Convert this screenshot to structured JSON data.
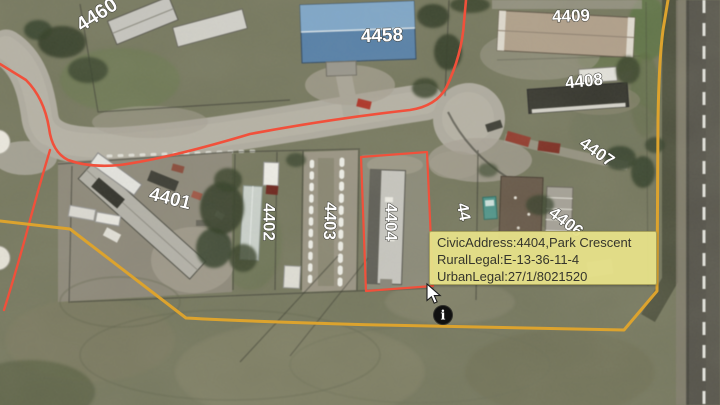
{
  "map_labels": {
    "l4460": "4460",
    "l4458": "4458",
    "l4409": "4409",
    "l4408": "4408",
    "l4407": "4407",
    "l4406": "4406",
    "l4405_partial": "44",
    "l4404": "4404",
    "l4403": "4403",
    "l4402": "4402",
    "l4401": "4401"
  },
  "tooltip": {
    "civic_address": "CivicAddress:4404,Park Crescent",
    "rural_legal": "RuralLegal:E-13-36-11-4",
    "urban_legal": "UrbanLegal:27/1/8021520",
    "background": "#e5e088",
    "text_color": "#35352c"
  },
  "info_marker": {
    "glyph": "i"
  },
  "overlay_colors": {
    "boundary_red": "#f1503b",
    "selected_parcel_red": "#f1503b",
    "boundary_yellow": "#dca32e",
    "parcel_label_fill": "#ffffff",
    "parcel_label_outline": "#3a3a33"
  }
}
